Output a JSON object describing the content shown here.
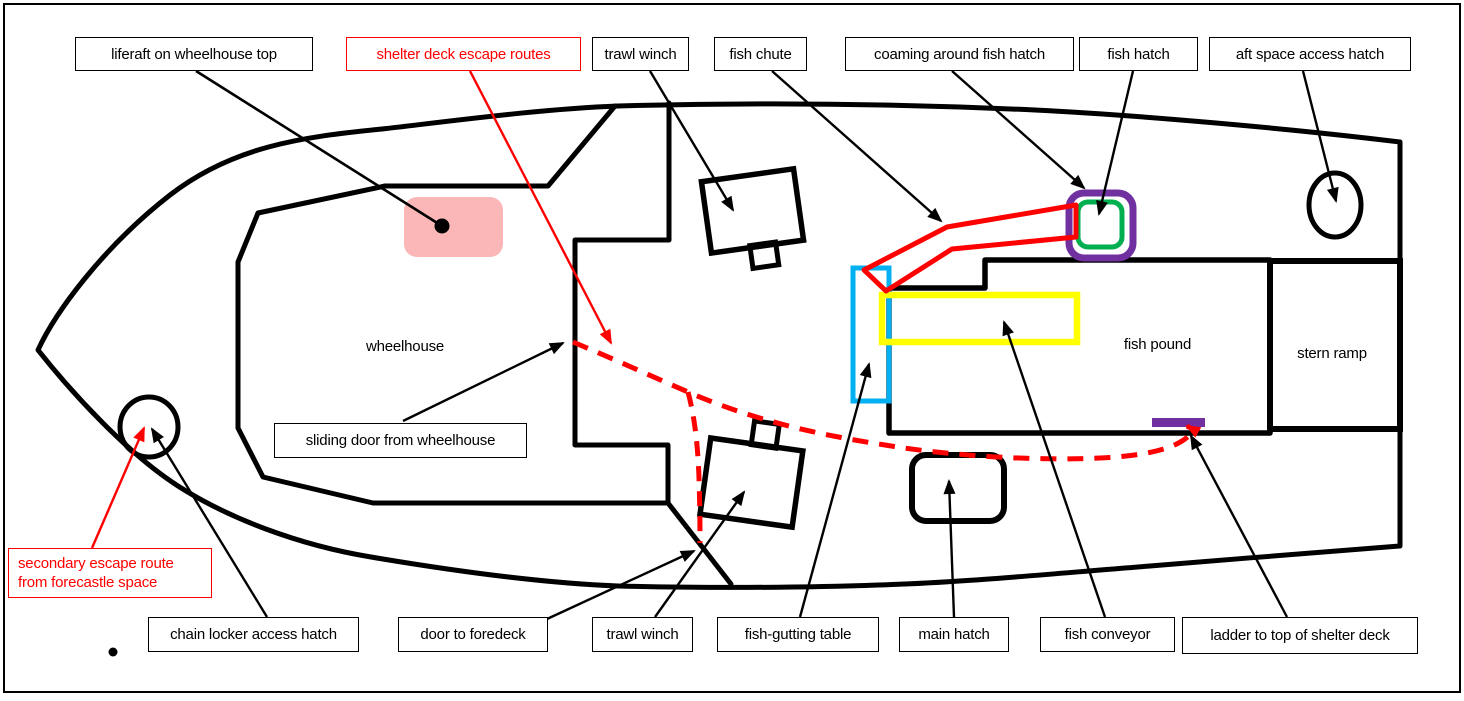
{
  "canvas": {
    "width": 1464,
    "height": 701,
    "background": "#FFFFFF",
    "frame_color": "#000000"
  },
  "colors": {
    "black": "#000000",
    "red": "#FF0000",
    "pink": "#FBB7B7",
    "cyan": "#00B0F0",
    "yellow": "#FFFF00",
    "green": "#00B050",
    "purple": "#7030A0",
    "white": "#FFFFFF"
  },
  "top_labels": [
    {
      "id": "liferaft-on-wheelhouse-top",
      "text": "liferaft on wheelhouse top",
      "style": "black"
    },
    {
      "id": "shelter-deck-escape-routes",
      "text": "shelter deck escape routes",
      "style": "red"
    },
    {
      "id": "trawl-winch-top",
      "text": "trawl winch",
      "style": "black"
    },
    {
      "id": "fish-chute",
      "text": "fish chute",
      "style": "black"
    },
    {
      "id": "coaming-around-fish-hatch",
      "text": "coaming around fish hatch",
      "style": "black"
    },
    {
      "id": "fish-hatch",
      "text": "fish hatch",
      "style": "black"
    },
    {
      "id": "aft-space-access-hatch",
      "text": "aft space access hatch",
      "style": "black"
    }
  ],
  "bottom_labels": [
    {
      "id": "chain-locker-access-hatch",
      "text": "chain locker access hatch"
    },
    {
      "id": "door-to-foredeck",
      "text": "door to foredeck"
    },
    {
      "id": "trawl-winch-bottom",
      "text": "trawl winch"
    },
    {
      "id": "fish-gutting-table",
      "text": "fish-gutting table"
    },
    {
      "id": "main-hatch",
      "text": "main hatch"
    },
    {
      "id": "fish-conveyor",
      "text": "fish conveyor"
    },
    {
      "id": "ladder-to-top-of-shelter-deck",
      "text": "ladder to top of shelter deck"
    }
  ],
  "floating_labels": {
    "sliding_door": {
      "text": "sliding door from wheelhouse"
    },
    "secondary_escape": {
      "lines": [
        "secondary escape route",
        "from forecastle space"
      ],
      "style": "red"
    }
  },
  "deck_texts": {
    "wheelhouse": "wheelhouse",
    "fish_pound": "fish pound",
    "stern_ramp": "stern ramp"
  }
}
